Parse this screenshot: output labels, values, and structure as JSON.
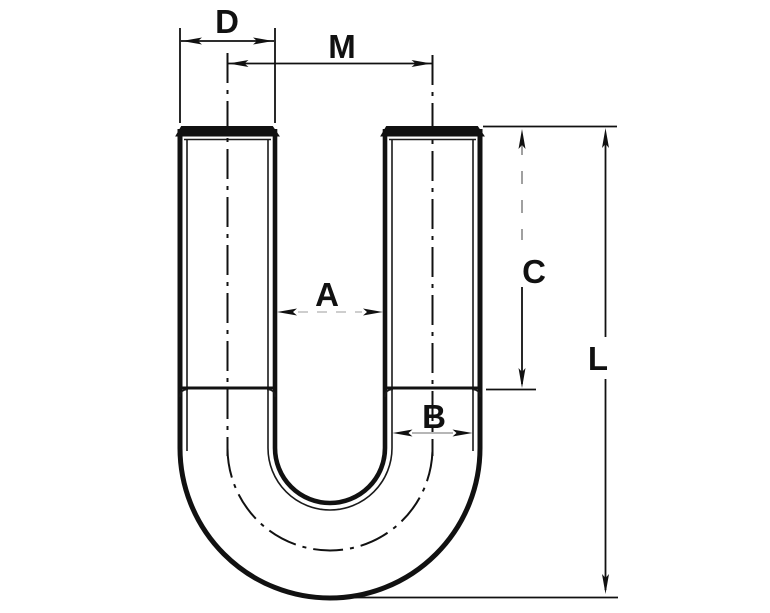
{
  "figure": {
    "kind": "U-bolt technical line drawing",
    "background_color": "#ffffff",
    "line_color": "#111111"
  },
  "labels": {
    "d": "D",
    "m": "M",
    "a": "A",
    "b": "B",
    "c": "C",
    "l": "L"
  }
}
